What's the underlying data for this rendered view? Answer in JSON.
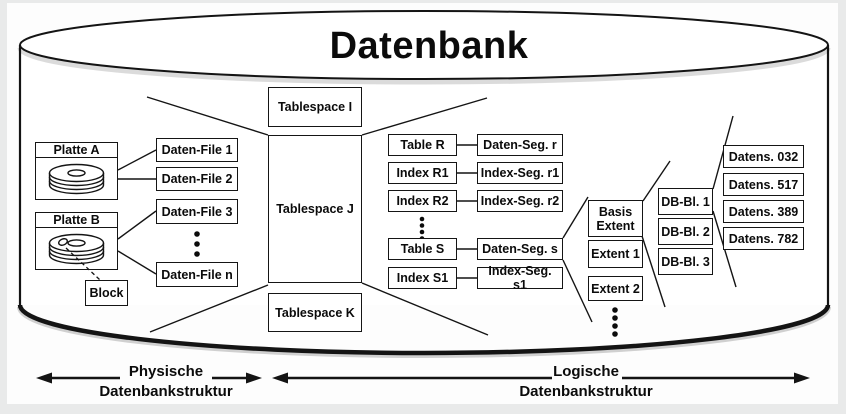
{
  "title": "Datenbank",
  "disks": {
    "a": "Platte A",
    "b": "Platte B",
    "block": "Block"
  },
  "files": {
    "f1": "Daten-File 1",
    "f2": "Daten-File 2",
    "f3": "Daten-File 3",
    "fn": "Daten-File n"
  },
  "tablespaces": {
    "i": "Tablespace I",
    "j": "Tablespace J",
    "k": "Tablespace K"
  },
  "tables": {
    "r": "Table R",
    "r1": "Index R1",
    "r2": "Index R2",
    "s": "Table S",
    "s1": "Index S1"
  },
  "segments": {
    "r": "Daten-Seg. r",
    "r1": "Index-Seg. r1",
    "r2": "Index-Seg. r2",
    "s": "Daten-Seg. s",
    "s1": "Index-Seg. s1"
  },
  "extents": {
    "basis": "Basis Extent",
    "e1": "Extent 1",
    "e2": "Extent 2"
  },
  "blocks": {
    "b1": "DB-Bl. 1",
    "b2": "DB-Bl. 2",
    "b3": "DB-Bl. 3"
  },
  "records": {
    "r1": "Datens. 032",
    "r2": "Datens. 517",
    "r3": "Datens. 389",
    "r4": "Datens. 782"
  },
  "legend": {
    "physical": {
      "line1": "Physische",
      "line2": "Datenbankstruktur"
    },
    "logical": {
      "line1": "Logische",
      "line2": "Datenbankstruktur"
    }
  },
  "colors": {
    "ink": "#141414",
    "paper": "#ffffff",
    "frame": "#e9eaea"
  }
}
